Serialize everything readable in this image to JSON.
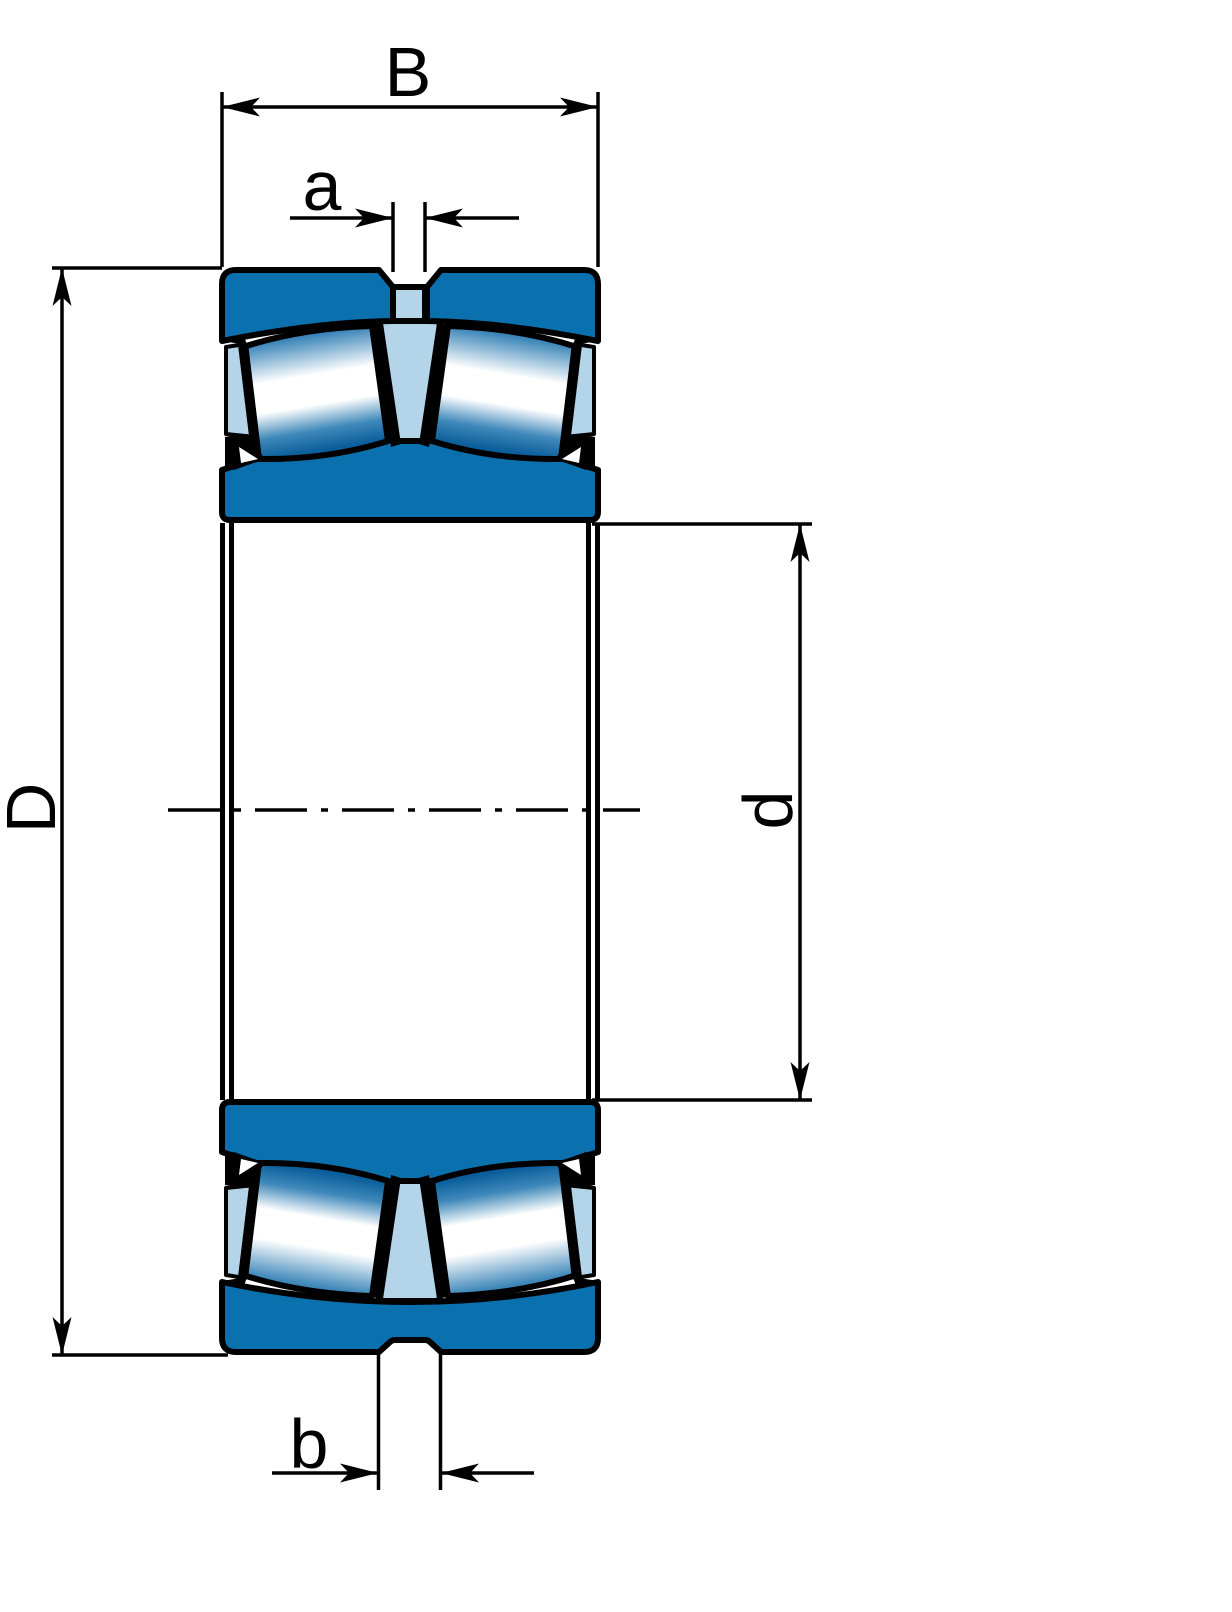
{
  "dimensions": {
    "width_label": "B",
    "groove_top_label": "a",
    "outside_diameter_label": "D",
    "bore_diameter_label": "d",
    "groove_bottom_label": "b"
  },
  "colors": {
    "ring_fill": "#0b70ae",
    "cage_fill": "#b4d4e9",
    "roller_edge": "#0a5e9b",
    "roller_highlight": "#ffffff",
    "line": "#000000",
    "background": "#ffffff"
  }
}
